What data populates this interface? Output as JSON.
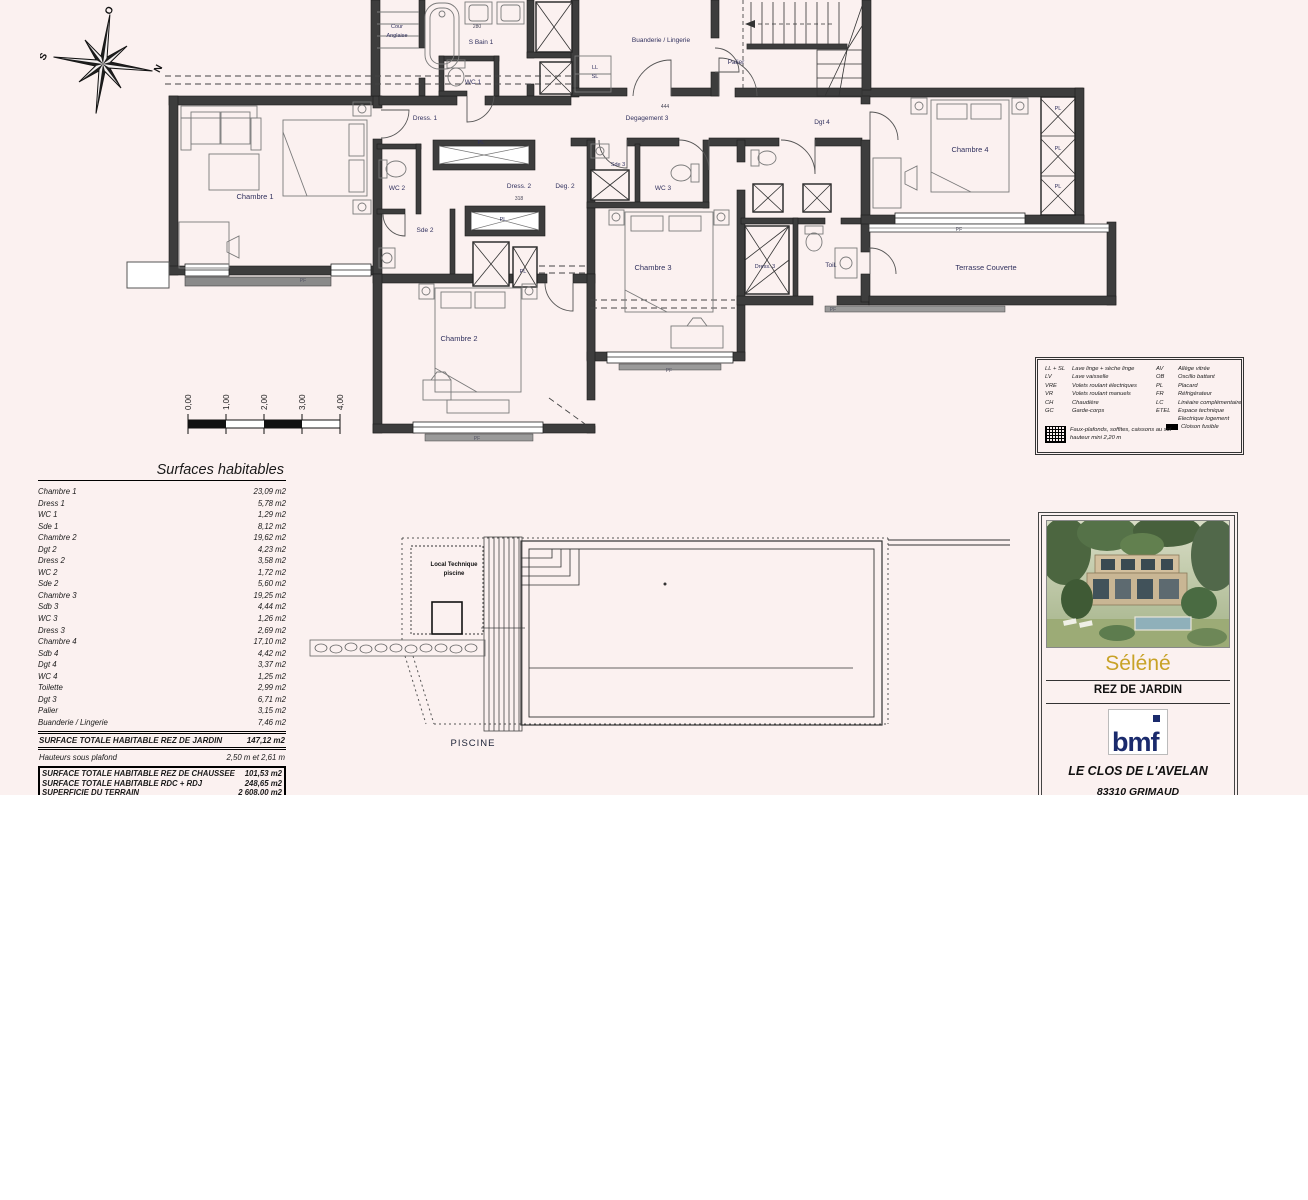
{
  "sheet": {
    "bg": "#fbf1f0"
  },
  "compass": {
    "o": "O",
    "n": "N",
    "e": "E",
    "s": "S"
  },
  "plan": {
    "rooms": {
      "cour1": "Cour",
      "cour2": "Anglaise",
      "sbain1": "S Bain 1",
      "wc1": "WC 1",
      "dress1": "Dress. 1",
      "buanderie": "Buanderie / Lingerie",
      "ll": "LL",
      "sl": "SL",
      "palier": "Palier",
      "degagement3": "Degagement 3",
      "dgt4": "Dgt 4",
      "chambre4": "Chambre 4",
      "pl": "PL",
      "chambre1": "Chambre 1",
      "wc2": "WC 2",
      "dress2": "Dress. 2",
      "deg2": "Deg. 2",
      "sde3": "Sde 3",
      "wc3": "WC 3",
      "sde2": "Sde 2",
      "chambre3": "Chambre 3",
      "dress3": "Dress. 3",
      "toil": "Toil.",
      "terrasse": "Terrasse Couverte",
      "chambre2": "Chambre 2",
      "pf": "PF"
    },
    "dims": {
      "d1": "280",
      "d2": "318",
      "d3": "444"
    }
  },
  "scalebar": {
    "l0": "0,00",
    "l1": "1,00",
    "l2": "2,00",
    "l3": "3,00",
    "l4": "4,00"
  },
  "surfaces": {
    "title": "Surfaces habitables",
    "rows": [
      {
        "label": "Chambre 1",
        "value": "23,09 m2"
      },
      {
        "label": "Dress 1",
        "value": "5,78 m2"
      },
      {
        "label": "WC 1",
        "value": "1,29 m2"
      },
      {
        "label": "Sde 1",
        "value": "8,12 m2"
      },
      {
        "label": "Chambre 2",
        "value": "19,62 m2"
      },
      {
        "label": "Dgt 2",
        "value": "4,23 m2"
      },
      {
        "label": "Dress 2",
        "value": "3,58 m2"
      },
      {
        "label": "WC 2",
        "value": "1,72 m2"
      },
      {
        "label": "Sde 2",
        "value": "5,60 m2"
      },
      {
        "label": "Chambre 3",
        "value": "19,25 m2"
      },
      {
        "label": "Sdb 3",
        "value": "4,44 m2"
      },
      {
        "label": "WC 3",
        "value": "1,26 m2"
      },
      {
        "label": "Dress 3",
        "value": "2,69 m2"
      },
      {
        "label": "Chambre 4",
        "value": "17,10 m2"
      },
      {
        "label": "Sdb 4",
        "value": "4,42 m2"
      },
      {
        "label": "Dgt 4",
        "value": "3,37 m2"
      },
      {
        "label": "WC 4",
        "value": "1,25 m2"
      },
      {
        "label": "Toilette",
        "value": "2,99 m2"
      },
      {
        "label": "Dgt 3",
        "value": "6,71 m2"
      },
      {
        "label": "Palier",
        "value": "3,15 m2"
      },
      {
        "label": "Buanderie / Lingerie",
        "value": "7,46 m2"
      }
    ],
    "total_label": "SURFACE TOTALE HABITABLE REZ DE JARDIN",
    "total_value": "147,12 m2",
    "ceiling_label": "Hauteurs sous plafond",
    "ceiling_value": "2,50 m et 2,61 m",
    "totals_box": [
      {
        "label": "SURFACE TOTALE HABITABLE REZ DE CHAUSSEE",
        "value": "101,53 m2"
      },
      {
        "label": "SURFACE TOTALE HABITABLE RDC + RDJ",
        "value": "248,65 m2"
      },
      {
        "label": "SUPERFICIE DU TERRAIN",
        "value": "2 608,00 m2"
      }
    ]
  },
  "pool": {
    "local1": "Local Technique",
    "local2": "piscine",
    "title": "PISCINE"
  },
  "legend": {
    "rows1": [
      {
        "abbr": "LL + SL",
        "desc": "Lave linge + sèche linge"
      },
      {
        "abbr": "LV",
        "desc": "Lave vaisselle"
      },
      {
        "abbr": "VRE",
        "desc": "Volets roulant électriques"
      },
      {
        "abbr": "VR",
        "desc": "Volets roulant manuels"
      },
      {
        "abbr": "CH",
        "desc": "Chaudière"
      },
      {
        "abbr": "GC",
        "desc": "Garde-corps"
      }
    ],
    "rows2": [
      {
        "abbr": "AV",
        "desc": "Allège vitrée"
      },
      {
        "abbr": "OB",
        "desc": "Oscillo battant"
      },
      {
        "abbr": "PL",
        "desc": "Placard"
      },
      {
        "abbr": "FR",
        "desc": "Réfrigérateur"
      },
      {
        "abbr": "LC",
        "desc": "Linéaire complémentaire"
      },
      {
        "abbr": "ETEL",
        "desc": "Espace technique"
      }
    ],
    "electrique": "Electrique logement",
    "cloison": "Cloison fusible",
    "note1": "Faux-plafonds, soffites, caissons au sol",
    "note2": "hauteur mini 2,20 m"
  },
  "titleblock": {
    "project": "Séléné",
    "level": "REZ DE JARDIN",
    "logo": "bmf",
    "address1": "LE CLOS DE L'AVELAN",
    "address2": "83310 GRIMAUD",
    "accent": "#c8a227"
  }
}
